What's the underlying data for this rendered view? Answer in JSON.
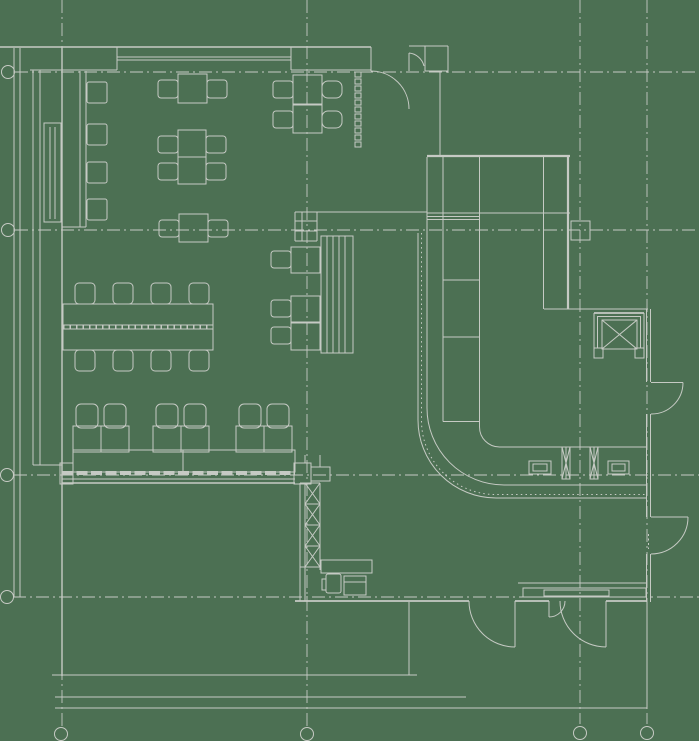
{
  "meta": {
    "title": "Cafe floor plan - CAD top-down drawing",
    "drawing_type": "architectural-floor-plan"
  },
  "colors": {
    "background": "#4c7053",
    "line": "#c6cac4",
    "line_strong": "#d3d6d1"
  },
  "canvas": {
    "width": 699,
    "height": 741
  },
  "grid": {
    "bubble_radius": 6.5,
    "vertical": [
      {
        "x": 62,
        "y1": 0,
        "y2": 726,
        "bubble": {
          "cx": 61,
          "cy": 734
        }
      },
      {
        "x": 307,
        "y1": 0,
        "y2": 726,
        "bubble": {
          "cx": 307,
          "cy": 734
        }
      },
      {
        "x": 580,
        "y1": 0,
        "y2": 724,
        "bubble": {
          "cx": 580,
          "cy": 733
        }
      },
      {
        "x": 647,
        "y1": 0,
        "y2": 724,
        "bubble": {
          "cx": 647,
          "cy": 733
        }
      }
    ],
    "horizontal": [
      {
        "y": 72,
        "x1": 15,
        "x2": 699,
        "bubble": {
          "cx": 8,
          "cy": 72
        }
      },
      {
        "y": 230,
        "x1": 15,
        "x2": 699,
        "bubble": {
          "cx": 8,
          "cy": 230
        }
      },
      {
        "y": 475,
        "x1": 14,
        "x2": 699,
        "bubble": {
          "cx": 7,
          "cy": 475
        }
      },
      {
        "y": 597,
        "x1": 13,
        "x2": 699,
        "bubble": {
          "cx": 7,
          "cy": 597
        }
      }
    ]
  },
  "inventory": {
    "small_tables": 9,
    "long_tables": 1,
    "chairs": 27,
    "lounge_chairs": 6,
    "wall_benches": 2,
    "bar_counters": 1,
    "banquette_booths": 1,
    "elevators": 1,
    "service_shafts": 1,
    "columns": 1,
    "door_openings": 5,
    "cash_registers": 2,
    "bar_taps": 2,
    "kitchen_machines": 2,
    "display_shelf_trays": 11
  }
}
